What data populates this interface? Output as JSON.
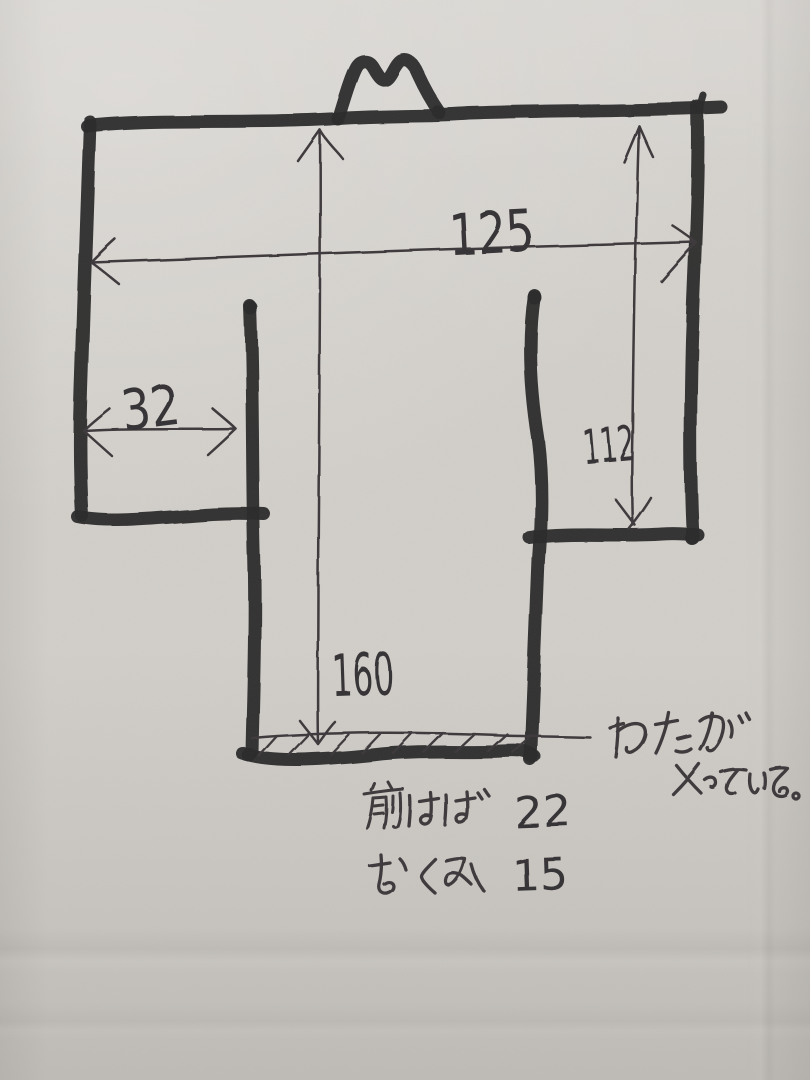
{
  "sketch": {
    "measurements": {
      "overall_width": "125",
      "sleeve_width": "32",
      "sleeve_depth": "112",
      "body_length": "160",
      "front_width_value": "22",
      "okumi_value": "15"
    },
    "notes": {
      "padding_note_line1": "わたが",
      "padding_note_line2": "入っている。",
      "front_width_label": "前はば",
      "okumi_label": "おくみ"
    },
    "colors": {
      "paper": "#d2cfca",
      "marker_ink": "#2b2a2c",
      "pen_ink": "#3c393b"
    }
  }
}
